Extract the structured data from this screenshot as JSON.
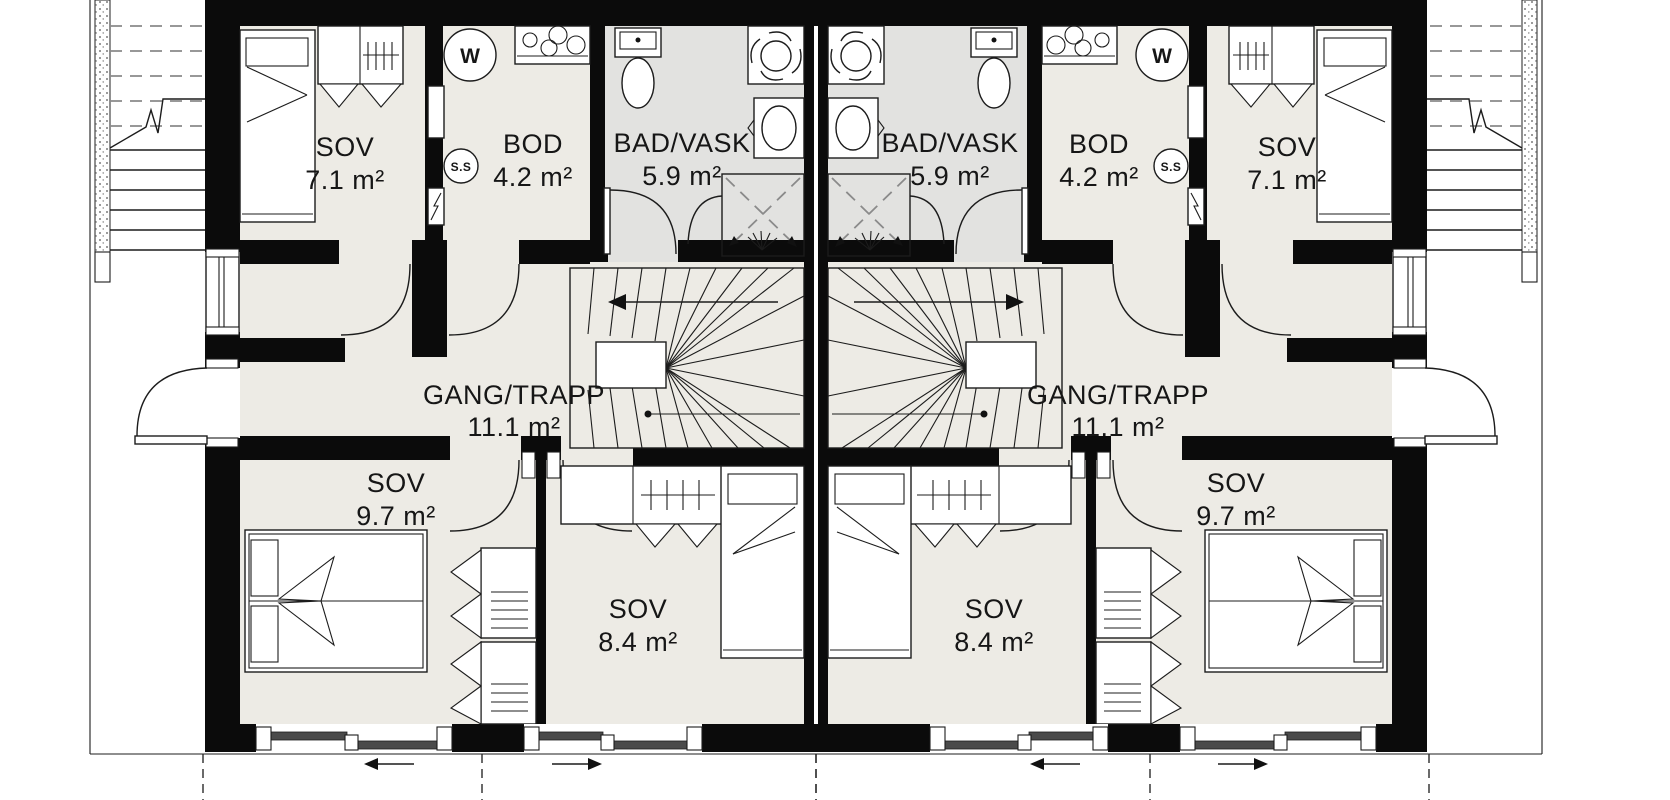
{
  "plan": {
    "type": "residential-floor-plan-mirrored-duplex",
    "language": "Norwegian",
    "rooms": [
      {
        "label": "SOV",
        "area": "7.1 m²"
      },
      {
        "label": "BOD",
        "area": "4.2 m²"
      },
      {
        "label": "BAD/VASK",
        "area": "5.9 m²"
      },
      {
        "label": "GANG/TRAPP",
        "area": "11.1 m²"
      },
      {
        "label": "SOV",
        "area": "9.7 m²"
      },
      {
        "label": "SOV",
        "area": "8.4 m²"
      }
    ],
    "units": [
      "left",
      "right"
    ],
    "appliances": {
      "washing_machine_label": "W",
      "fuse_box_label": "S.S"
    },
    "icons": [
      "washing-machine-icon",
      "fuse-box-icon",
      "toilet-icon",
      "extractor-fan-icon",
      "sink-icon",
      "shower-icon",
      "stove-icon",
      "single-bed",
      "double-bed",
      "wardrobe",
      "interior-winder-stair",
      "exterior-stair",
      "entry-door",
      "sliding-window"
    ],
    "colors": {
      "wall": "#0b0b0b",
      "room_floor": "#edebe5",
      "bathroom_floor": "#e2e2e0",
      "line": "#1c1c1c",
      "background": "#ffffff"
    }
  }
}
